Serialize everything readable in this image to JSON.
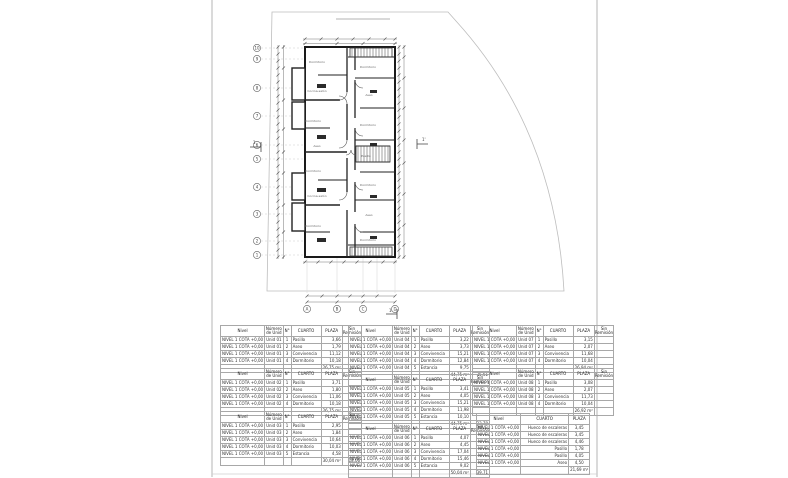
{
  "plan": {
    "left_bubbles": [
      "10",
      "9",
      "8",
      "7",
      "6",
      "5",
      "4",
      "3",
      "2",
      "1"
    ],
    "bottom_bubbles": [
      "A",
      "B",
      "C",
      "D"
    ],
    "section_markers": {
      "left": "1",
      "right": "1'",
      "bottom": "1"
    },
    "room_labels": [
      "Dormitorio",
      "Dormitorio",
      "Cocina-salón",
      "Aseo",
      "Dormitorio",
      "Dormitorio",
      "Aseo",
      "Pasillo",
      "Dormitorio",
      "Dormitorio",
      "Cocina-salón",
      "Aseo",
      "Dormitorio",
      "Dormitorio"
    ]
  },
  "area_tables": {
    "columns": [
      "Nivel",
      "Número de Unid",
      "N°",
      "CUARTO",
      "PLAZA",
      "Sin Remisión"
    ],
    "stairs_columns": [
      "Nivel",
      "CUARTO",
      "PLAZA"
    ],
    "left": [
      {
        "rows": [
          [
            "NIVEL 1 COTA +0,00",
            "Unid 01",
            "1",
            "Pasillo",
            "3,66",
            ""
          ],
          [
            "NIVEL 1 COTA +0,00",
            "Unid 01",
            "2",
            "Aseo",
            "1,79",
            ""
          ],
          [
            "NIVEL 1 COTA +0,00",
            "Unid 01",
            "3",
            "Convivencia",
            "11,12",
            ""
          ],
          [
            "NIVEL 1 COTA +0,00",
            "Unid 01",
            "4",
            "Dormitorio",
            "10,18",
            ""
          ]
        ],
        "total": [
          "",
          "",
          "",
          "",
          "26,75 m²",
          ""
        ]
      },
      {
        "rows": [
          [
            "NIVEL 1 COTA +0,00",
            "Unid 02",
            "1",
            "Pasillo",
            "3,71",
            ""
          ],
          [
            "NIVEL 1 COTA +0,00",
            "Unid 02",
            "2",
            "Aseo",
            "1,80",
            ""
          ],
          [
            "NIVEL 1 COTA +0,00",
            "Unid 02",
            "3",
            "Convivencia",
            "11,06",
            ""
          ],
          [
            "NIVEL 1 COTA +0,00",
            "Unid 02",
            "4",
            "Dormitorio",
            "10,18",
            ""
          ]
        ],
        "total": [
          "",
          "",
          "",
          "",
          "26,75 m²",
          ""
        ]
      },
      {
        "rows": [
          [
            "NIVEL 1 COTA +0,00",
            "Unid 03",
            "1",
            "Pasillo",
            "2,95",
            ""
          ],
          [
            "NIVEL 1 COTA +0,00",
            "Unid 03",
            "2",
            "Aseo",
            "1,84",
            ""
          ],
          [
            "NIVEL 1 COTA +0,00",
            "Unid 03",
            "3",
            "Convivencia",
            "10,64",
            ""
          ],
          [
            "NIVEL 1 COTA +0,00",
            "Unid 03",
            "4",
            "Dormitorio",
            "10,03",
            ""
          ],
          [
            "NIVEL 1 COTA +0,00",
            "Unid 03",
            "5",
            "Estancia",
            "4,58",
            ""
          ]
        ],
        "total": [
          "",
          "",
          "",
          "",
          "30,04 m²",
          "18,06"
        ]
      }
    ],
    "middle": [
      {
        "rows": [
          [
            "NIVEL 1 COTA +0,00",
            "Unid 04",
            "1",
            "Pasillo",
            "3,22",
            ""
          ],
          [
            "NIVEL 1 COTA +0,00",
            "Unid 04",
            "2",
            "Aseo",
            "3,73",
            ""
          ],
          [
            "NIVEL 1 COTA +0,00",
            "Unid 04",
            "3",
            "Convivencia",
            "15,21",
            ""
          ],
          [
            "NIVEL 1 COTA +0,00",
            "Unid 04",
            "4",
            "Dormitorio",
            "12,84",
            ""
          ],
          [
            "NIVEL 1 COTA +0,00",
            "Unid 04",
            "5",
            "Estancia",
            "9,75",
            ""
          ]
        ],
        "total": [
          "",
          "",
          "",
          "",
          "44,75 m²",
          "35,61"
        ]
      },
      {
        "rows": [
          [
            "NIVEL 1 COTA +0,00",
            "Unid 05",
            "1",
            "Pasillo",
            "3,41",
            ""
          ],
          [
            "NIVEL 1 COTA +0,00",
            "Unid 05",
            "2",
            "Aseo",
            "4,05",
            ""
          ],
          [
            "NIVEL 1 COTA +0,00",
            "Unid 05",
            "3",
            "Convivencia",
            "15,21",
            ""
          ],
          [
            "NIVEL 1 COTA +0,00",
            "Unid 05",
            "4",
            "Dormitorio",
            "11,98",
            ""
          ],
          [
            "NIVEL 1 COTA +0,00",
            "Unid 05",
            "5",
            "Estancia",
            "10,10",
            ""
          ]
        ],
        "total": [
          "",
          "",
          "",
          "",
          "44,75 m²",
          "33,70"
        ]
      },
      {
        "rows": [
          [
            "NIVEL 1 COTA +0,00",
            "Unid 06",
            "1",
            "Pasillo",
            "4,07",
            ""
          ],
          [
            "NIVEL 1 COTA +0,00",
            "Unid 06",
            "2",
            "Aseo",
            "4,45",
            ""
          ],
          [
            "NIVEL 1 COTA +0,00",
            "Unid 06",
            "3",
            "Convivencia",
            "17,04",
            ""
          ],
          [
            "NIVEL 1 COTA +0,00",
            "Unid 06",
            "4",
            "Dormitorio",
            "15,46",
            ""
          ],
          [
            "NIVEL 1 COTA +0,00",
            "Unid 06",
            "5",
            "Estancia",
            "9,02",
            ""
          ]
        ],
        "total": [
          "",
          "",
          "",
          "",
          "50,04 m²",
          "39,71"
        ]
      }
    ],
    "right": [
      {
        "rows": [
          [
            "NIVEL 1 COTA +0,00",
            "Unid 07",
            "1",
            "Pasillo",
            "3,15",
            ""
          ],
          [
            "NIVEL 1 COTA +0,00",
            "Unid 07",
            "2",
            "Aseo",
            "2,07",
            ""
          ],
          [
            "NIVEL 1 COTA +0,00",
            "Unid 07",
            "3",
            "Convivencia",
            "11,68",
            ""
          ],
          [
            "NIVEL 1 COTA +0,00",
            "Unid 07",
            "4",
            "Dormitorio",
            "10,04",
            ""
          ]
        ],
        "total": [
          "",
          "",
          "",
          "",
          "26,94 m²",
          ""
        ]
      },
      {
        "rows": [
          [
            "NIVEL 1 COTA +0,00",
            "Unid 08",
            "1",
            "Pasillo",
            "3,08",
            ""
          ],
          [
            "NIVEL 1 COTA +0,00",
            "Unid 08",
            "2",
            "Aseo",
            "2,07",
            ""
          ],
          [
            "NIVEL 1 COTA +0,00",
            "Unid 08",
            "3",
            "Convivencia",
            "11,73",
            ""
          ],
          [
            "NIVEL 1 COTA +0,00",
            "Unid 08",
            "4",
            "Dormitorio",
            "10,04",
            ""
          ]
        ],
        "total": [
          "",
          "",
          "",
          "",
          "26,92 m²",
          ""
        ]
      }
    ],
    "stairs": {
      "rows": [
        [
          "NIVEL 1 COTA +0,00",
          "Hueco de escaleras",
          "3,45"
        ],
        [
          "NIVEL 1 COTA +0,00",
          "Hueco de escaleras",
          "3,45"
        ],
        [
          "NIVEL 1 COTA +0,00",
          "Hueco de escaleras",
          "4,46"
        ],
        [
          "NIVEL 1 COTA +0,00",
          "Pasillo",
          "1,78"
        ],
        [
          "NIVEL 1 COTA +0,00",
          "Pasillo",
          "4,05"
        ],
        [
          "NIVEL 1 COTA +0,00",
          "Aseo",
          "4,50"
        ]
      ],
      "total": [
        "",
        "",
        "21,69 m²"
      ]
    }
  }
}
